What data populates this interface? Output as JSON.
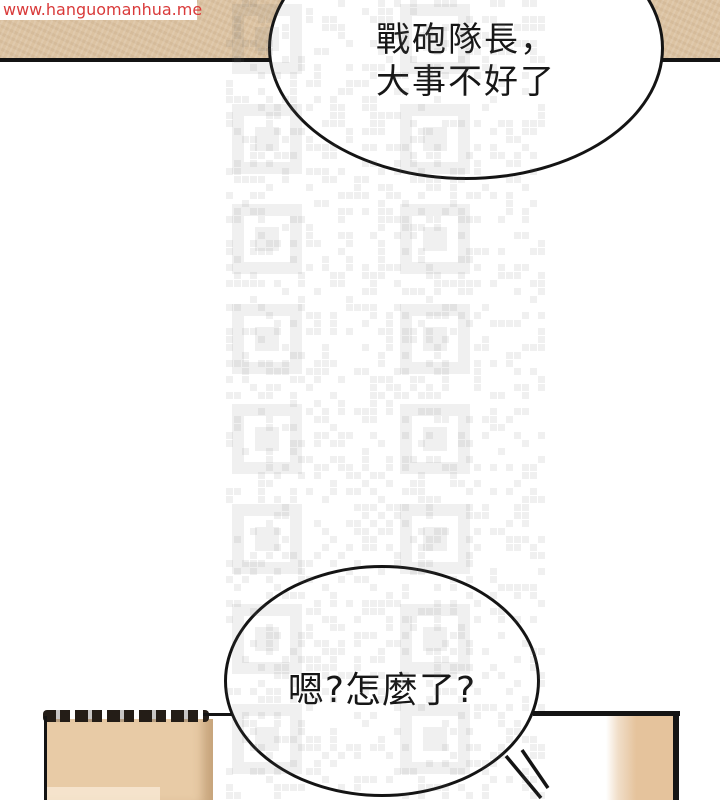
{
  "watermark": {
    "url_text": "www.hanguomanhua.me"
  },
  "dialogue": {
    "bubble_top": {
      "line1": "戰砲隊長，",
      "line2": "大事不好了"
    },
    "bubble_bottom": {
      "text": "嗯?怎麼了?"
    }
  },
  "colors": {
    "watermark_red": "#d93a3a",
    "top_band": "#dcc3a2",
    "panel_tan": "#e8cba6",
    "door_tan": "#e5c39c",
    "outline": "#141414",
    "qr_mark": "rgba(110,110,110,0.10)"
  }
}
